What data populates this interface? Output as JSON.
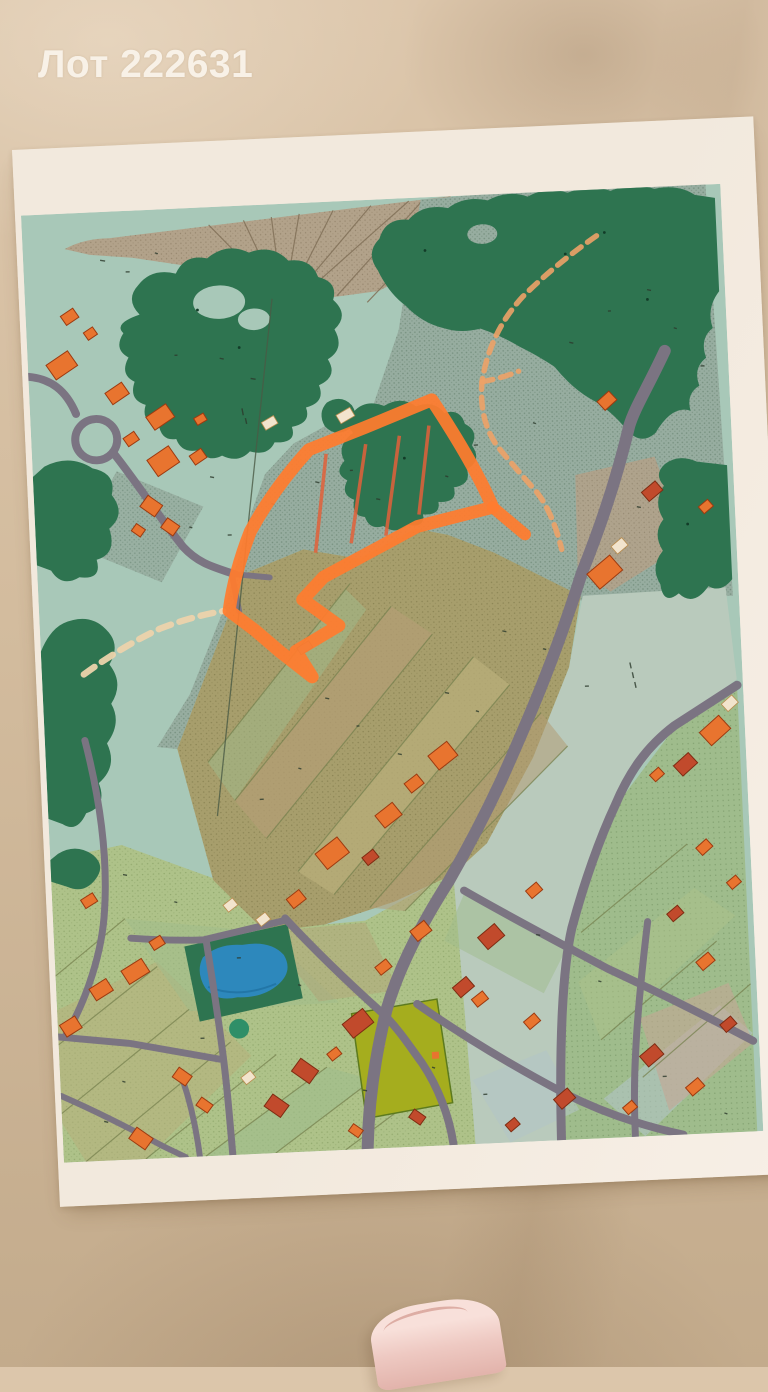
{
  "title": {
    "text": "Лот 222631"
  },
  "palette": {
    "bg-top": "#dcc6ab",
    "bg-mid": "#d3bc9e",
    "bg-bottom": "#c3ab8c",
    "paper": "#f2e9dd",
    "paper-edge": "#f7efe6",
    "title-color": "#f8f1e7",
    "map-base": "#a8c8b8",
    "hatch": "#97ada0",
    "hatch-dot": "#76907f",
    "field-pale": "#b9cabc",
    "tan-field": "#b2a28a",
    "tan-line": "#83725a",
    "forest": "#2e7450",
    "road": "#7b7482",
    "parcel-olive": "#a79e6c",
    "parcel-olive2": "#b8ae7a",
    "parcel-tan": "#b39d74",
    "parcel-green": "#aec289",
    "parcel-green2": "#9fbc8c",
    "parcel-blue": "#b3c4c6",
    "parcel-pink": "#c4a795",
    "chartreuse": "#a5ad1e",
    "bldg": "#e8742f",
    "bldg-stroke": "#9c3a10",
    "bldg-red": "#c14a2c",
    "bldg-cream": "#f2e4cd",
    "pond": "#2d88bc",
    "highlight": "#ff7c2e",
    "redline": "#e2603a",
    "sand": "#ecd3ab",
    "trail": "#eda267",
    "roll": "#eec9c2",
    "roll-light": "#f8e0da"
  }
}
